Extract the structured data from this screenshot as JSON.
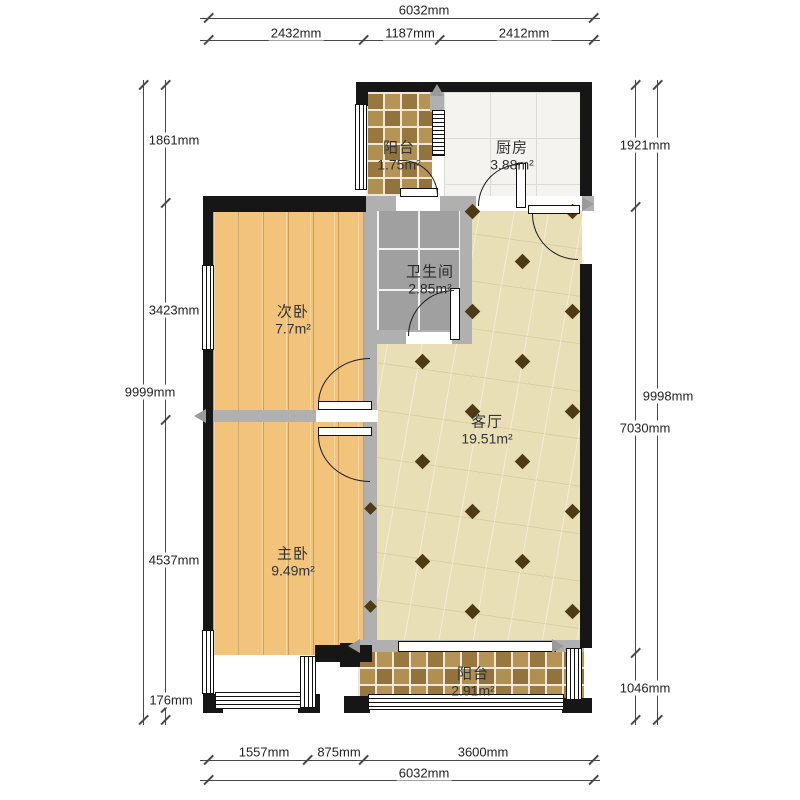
{
  "rooms": {
    "balcony_top": {
      "name": "阳台",
      "area": "1.75m²"
    },
    "kitchen": {
      "name": "厨房",
      "area": "3.88m²"
    },
    "bathroom": {
      "name": "卫生间",
      "area": "2.85m²"
    },
    "bedroom_second": {
      "name": "次卧",
      "area": "7.7m²"
    },
    "living": {
      "name": "客厅",
      "area": "19.51m²"
    },
    "bedroom_master": {
      "name": "主卧",
      "area": "9.49m²"
    },
    "balcony_bottom": {
      "name": "阳台",
      "area": "2.91m²"
    }
  },
  "dimensions": {
    "top": {
      "total": "6032mm",
      "segments": [
        "2432mm",
        "1187mm",
        "2412mm"
      ]
    },
    "bottom": {
      "total": "6032mm",
      "segments": [
        "1557mm",
        "875mm",
        "3600mm"
      ]
    },
    "left": {
      "total": "9999mm",
      "segments": [
        "1861mm",
        "3423mm",
        "4537mm",
        "176mm"
      ]
    },
    "right": {
      "total": "9998mm",
      "segments": [
        "1921mm",
        "7030mm",
        "1046mm"
      ]
    }
  },
  "colors": {
    "outer_wall": "#161616",
    "interior_wall": "#b0b0b0",
    "wood_floor": "#f1c37b",
    "balcony_tile": "#ad8c4f",
    "bath_tile": "#a0a0a0",
    "living_floor": "#e9dfb6",
    "kitchen_floor": "#f4f3f0",
    "diamond_accent": "#4c3b13"
  }
}
